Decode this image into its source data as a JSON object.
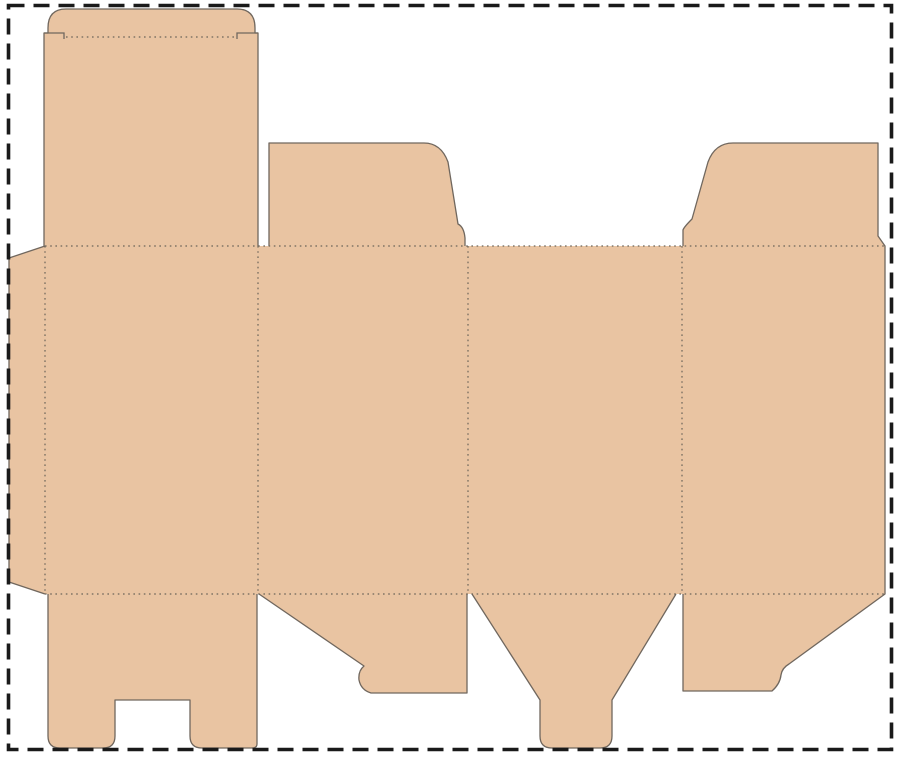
{
  "canvas": {
    "width": 900,
    "height": 759,
    "background": "#ffffff"
  },
  "colors": {
    "board_fill": "#e9c4a2",
    "cut_line": "#70675e",
    "fold_line": "#6b6359",
    "border": "#1a1a1a"
  },
  "border": {
    "x": 8.5,
    "y": 5.5,
    "width": 883,
    "height": 744,
    "stroke_width": 3.6,
    "dash": "16 9"
  },
  "board": {
    "cut_width": 1.3,
    "outline_path": "M 48 28 Q 48 9 66 9 L 237 9 Q 255 9 255 28 L 255 33 L 258 33 L 258 246 L 269 246 L 269 143 L 424 143 Q 441 143 448 162 L 458 224 Q 464 227 465 238 L 465 246 L 683 246 L 683 230 Q 684 227 692 219 L 708 162 Q 715 143 733 143 L 878 143 L 878 236 L 885 246 L 885 594 L 789 664 Q 782 668 781 675 Q 780 684 772 691 L 683 691 L 683 594 L 676 594 L 612 700 L 612 736 Q 612 748 600 748 L 552 748 Q 540 748 540 736 L 540 700 L 472 594 L 467 594 L 467 693 L 371 693 Q 361 690 359 680 Q 358 671 364 666 L 259 594 L 257 594 L 257 744 Q 257 748 252 748 L 202 748 Q 190 748 190 736 L 190 700 L 115 700 L 115 736 Q 115 748 103 748 L 60 748 Q 48 748 48 736 L 48 594 L 45 594 L 9 582 L 9 258 L 45 246 L 44 246 L 44 33 L 48 33 Z",
    "cut_path": "M 48 28 Q 48 9 66 9 L 237 9 Q 255 9 255 28 L 255 33 L 258 33 L 258 246 M 269 246 L 269 143 L 424 143 Q 441 143 448 162 L 458 224 Q 464 227 465 238 L 465 246 M 683 246 L 683 230 Q 684 227 692 219 L 708 162 Q 715 143 733 143 L 878 143 L 878 236 L 885 246 L 885 594 L 789 664 Q 782 668 781 675 Q 780 684 772 691 L 683 691 L 683 594 M 676 594 L 612 700 L 612 736 Q 612 748 600 748 L 552 748 Q 540 748 540 736 L 540 700 L 472 594 M 467 594 L 467 693 L 371 693 Q 361 690 359 680 Q 358 671 364 666 L 259 594 M 257 594 L 257 744 Q 257 748 252 748 L 202 748 Q 190 748 190 736 L 190 700 L 115 700 L 115 736 Q 115 748 103 748 L 60 748 Q 48 748 48 736 L 48 594 M 45 594 L 9 582 L 9 258 L 45 246 M 44 246 L 44 33 L 48 33 L 48 28"
  },
  "fold_style": {
    "stroke_width": 1.2,
    "dash": "1.6 3.6"
  },
  "fold_lines": [
    {
      "x1": 66,
      "y1": 37,
      "x2": 235,
      "y2": 37
    },
    {
      "x1": 45,
      "y1": 246,
      "x2": 885,
      "y2": 246
    },
    {
      "x1": 45,
      "y1": 594,
      "x2": 885,
      "y2": 594
    },
    {
      "x1": 45,
      "y1": 246,
      "x2": 45,
      "y2": 594
    },
    {
      "x1": 258,
      "y1": 246,
      "x2": 258,
      "y2": 594
    },
    {
      "x1": 468,
      "y1": 246,
      "x2": 468,
      "y2": 594
    },
    {
      "x1": 682,
      "y1": 246,
      "x2": 682,
      "y2": 594
    }
  ],
  "slit_marks": [
    "M 44 33 L 64 33 L 64 39",
    "M 258 33 L 237 33 L 237 39"
  ]
}
